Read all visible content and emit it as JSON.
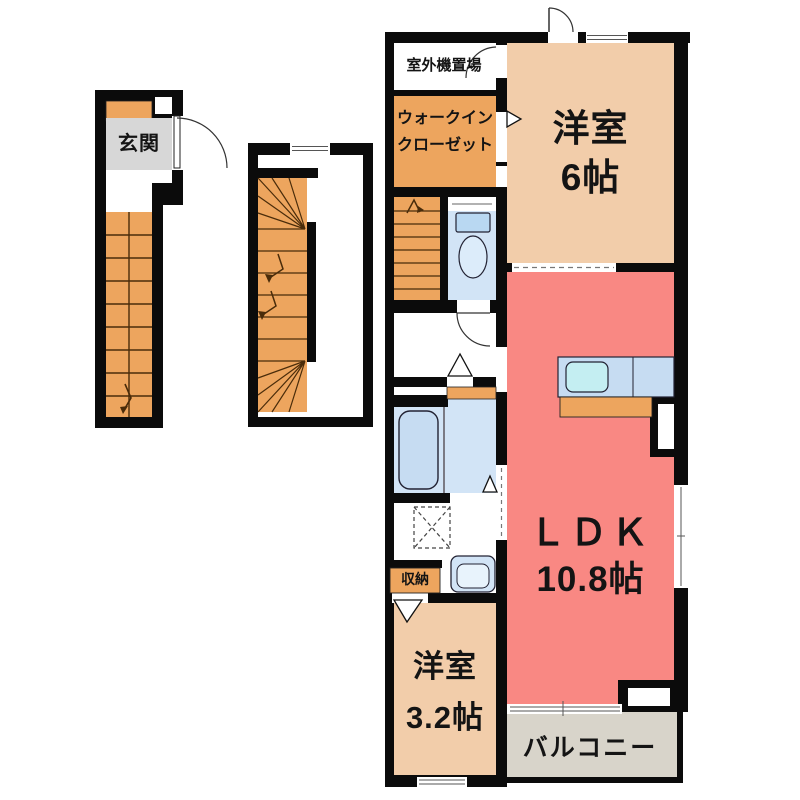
{
  "floorplan": {
    "entrance": {
      "label": "玄関"
    },
    "main": {
      "outdoor_unit": "室外機置場",
      "wic_line1": "ウォークイン",
      "wic_line2": "クローゼット",
      "room6_name": "洋室",
      "room6_size": "6帖",
      "ldk_name": "ＬＤＫ",
      "ldk_size": "10.8帖",
      "storage": "収納",
      "room32_name": "洋室",
      "room32_size": "3.2帖",
      "balcony": "バルコニー"
    },
    "colors": {
      "wall": "#0b0b0b",
      "stairs_orange": "#eda55e",
      "room_peach": "#f2cdaa",
      "ldk_salmon": "#f98883",
      "water_blue": "#d2e4f6",
      "tub_blue": "#c6dcf2",
      "sink_cyan": "#c4eef2",
      "balcony_gray": "#d8d4ca",
      "genkan_gray": "#d7d7d7",
      "line_brown": "#4a2c0a"
    }
  }
}
